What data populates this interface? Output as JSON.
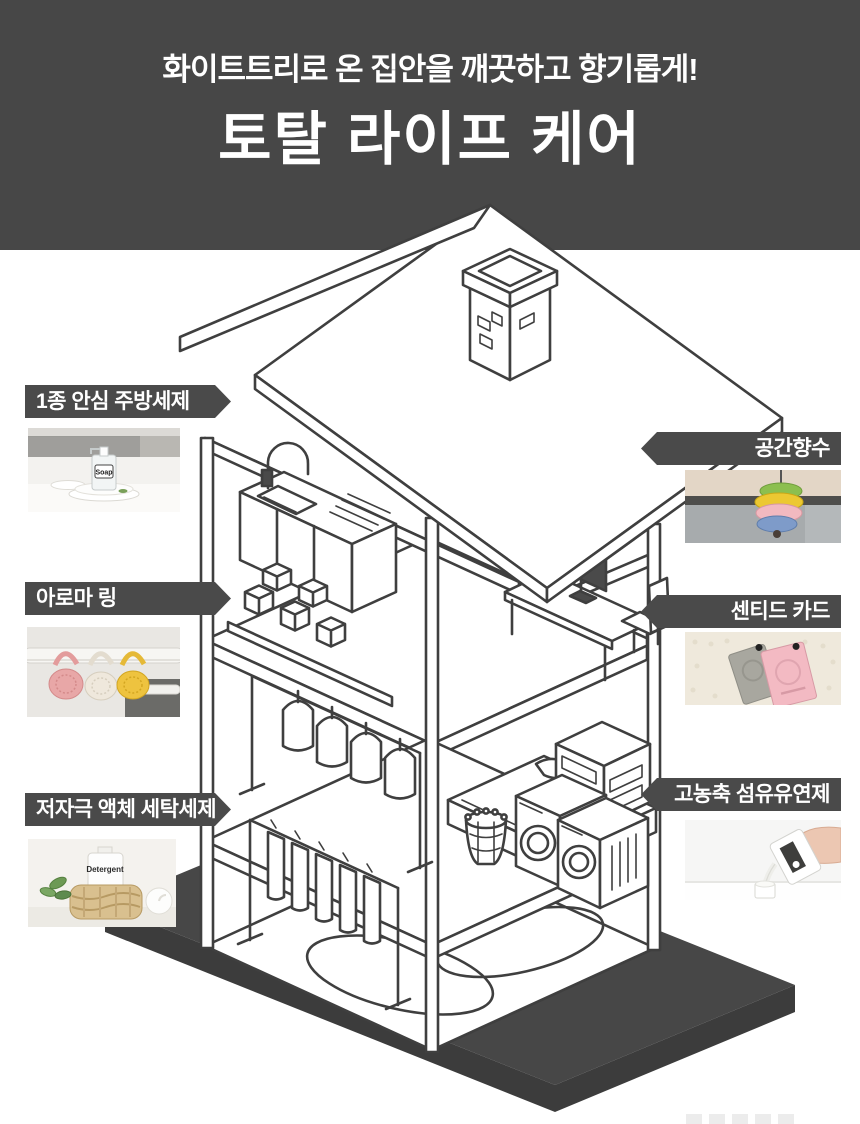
{
  "header": {
    "subtitle": "화이트트리로 온 집안을 깨끗하고 향기롭게!",
    "title": "토탈 라이프 케어",
    "bg_color": "#474747",
    "text_color": "#ffffff"
  },
  "callouts": {
    "bar_color": "#4a4a4a",
    "left": [
      {
        "label": "1종 안심 주방세제",
        "photo": "kitchen-soap-pump-on-plates",
        "photo_label": "Soap"
      },
      {
        "label": "아로마 링",
        "photo": "aroma-rings-on-closet-rail"
      },
      {
        "label": "저자극 액체 세탁세제",
        "photo": "detergent-bottle-in-wicker-basket",
        "photo_label": "Detergent"
      }
    ],
    "right": [
      {
        "label": "공간향수",
        "photo": "stacked-disc-air-freshener-in-car"
      },
      {
        "label": "센티드 카드",
        "photo": "gray-and-pink-scented-cards"
      },
      {
        "label": "고농축 섬유유연제",
        "photo": "hand-pouring-fabric-softener"
      }
    ]
  },
  "illustration": {
    "name": "isometric-house-cutaway",
    "line_color": "#3f3f3f",
    "base_color": "#474747",
    "rooms": [
      "kitchen",
      "home-office",
      "closet",
      "bedroom",
      "drying-room",
      "laundry-room"
    ]
  }
}
